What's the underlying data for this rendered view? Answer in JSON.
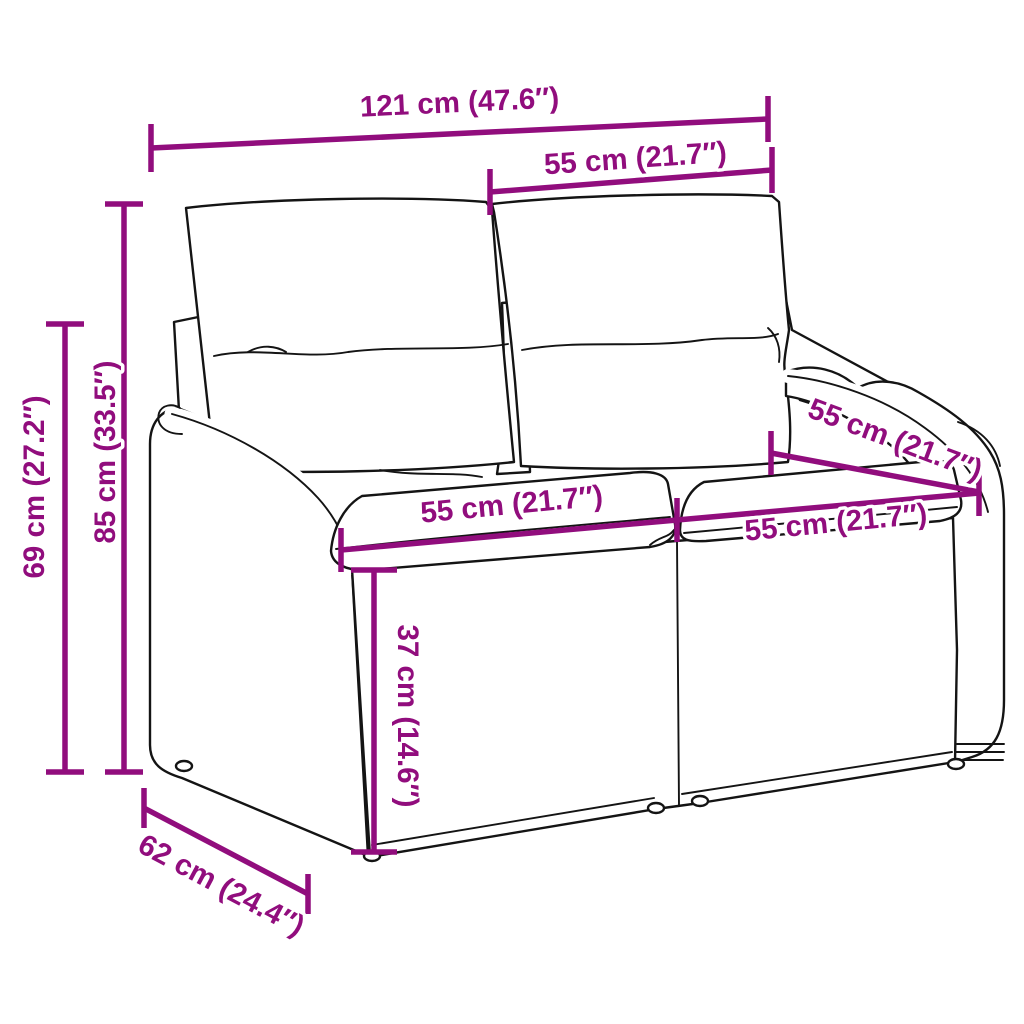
{
  "diagram": {
    "subject": "poly-rattan-garden-bench-with-cushions",
    "view": "dimension-drawing"
  },
  "labels": {
    "width_total": "121 cm (47.6″)",
    "back_cushion_width": "55 cm (21.7″)",
    "total_height": "85 cm (33.5″)",
    "arm_height": "69 cm (27.2″)",
    "base_depth": "62 cm (24.4″)",
    "seat_width_left": "55 cm (21.7″)",
    "seat_width_right": "55 cm (21.7″)",
    "seat_depth": "55 cm (21.7″)",
    "seat_height": "37 cm (14.6″)"
  },
  "colors": {
    "dimension": "#910d7d",
    "line_art": "#141414",
    "background": "#ffffff"
  }
}
